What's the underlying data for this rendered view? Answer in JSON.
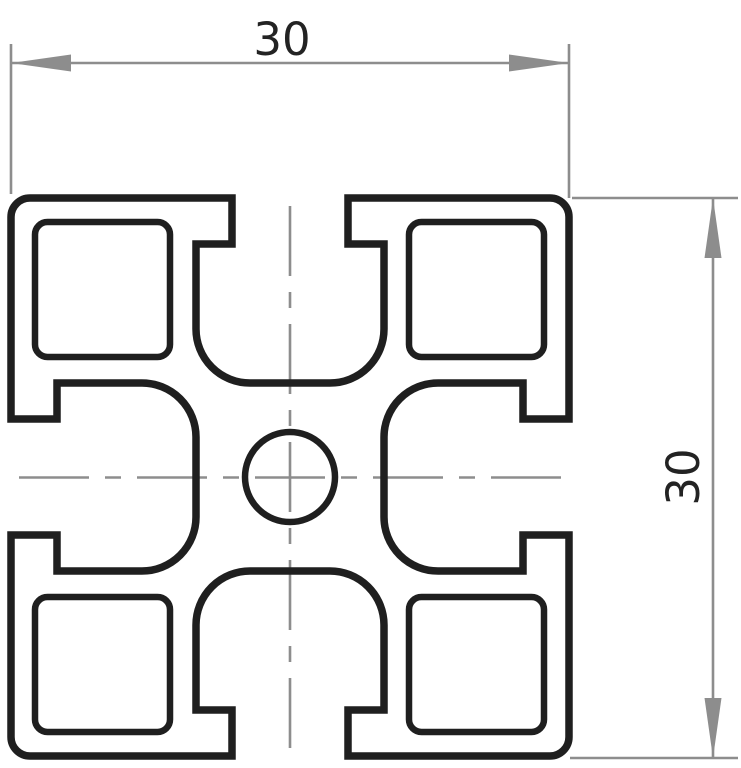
{
  "colors": {
    "background": "#ffffff",
    "outline": "#1f1f1f",
    "dimension_lines": "#8d8d8d",
    "dimension_text": "#232323"
  },
  "dimensions": {
    "width": {
      "value": "30"
    },
    "height": {
      "value": "30"
    }
  }
}
